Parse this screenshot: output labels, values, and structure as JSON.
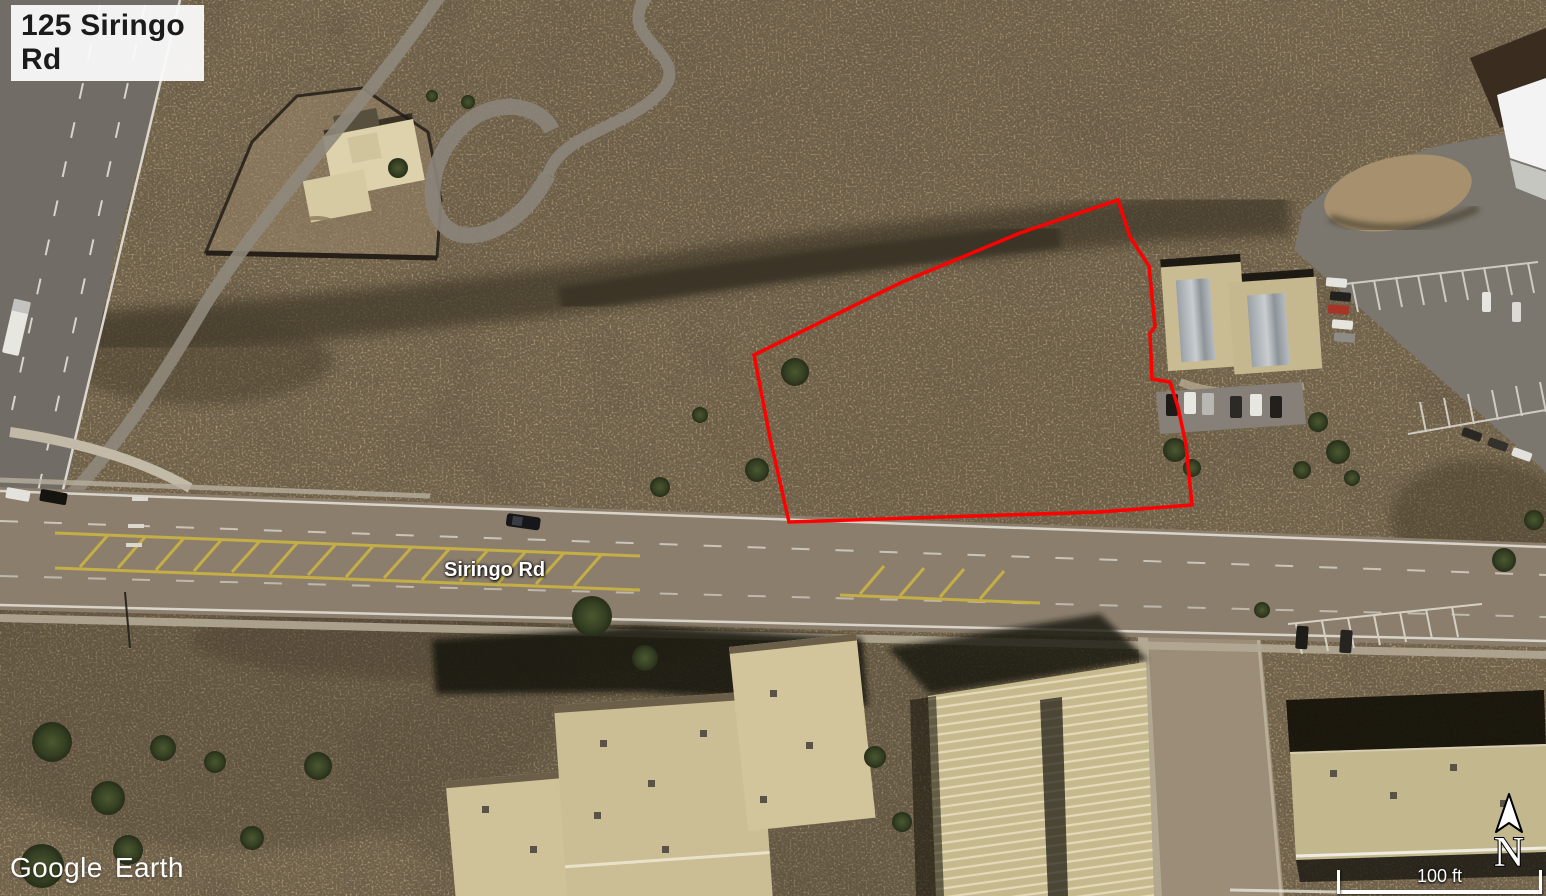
{
  "view": {
    "address_label": "125 Siringo Rd",
    "road_label": "Siringo Rd",
    "watermark": "Google Earth",
    "compass_label": "N",
    "scale_label": "100 ft"
  },
  "boundary": {
    "color": "#ff0000",
    "points": "754,355 900,283 1020,233 1118,200 1130,237 1149,266 1155,327 1150,333 1152,379 1170,382 1178,407 1186,445 1192,505 1100,512 789,522 770,438"
  },
  "colors": {
    "boundary_red": "#ff0000",
    "terrain_tan": "#97846a",
    "road_gray": "#8b7e6d",
    "overlay_text": "#ffffff",
    "address_text": "#1b1b1b"
  }
}
